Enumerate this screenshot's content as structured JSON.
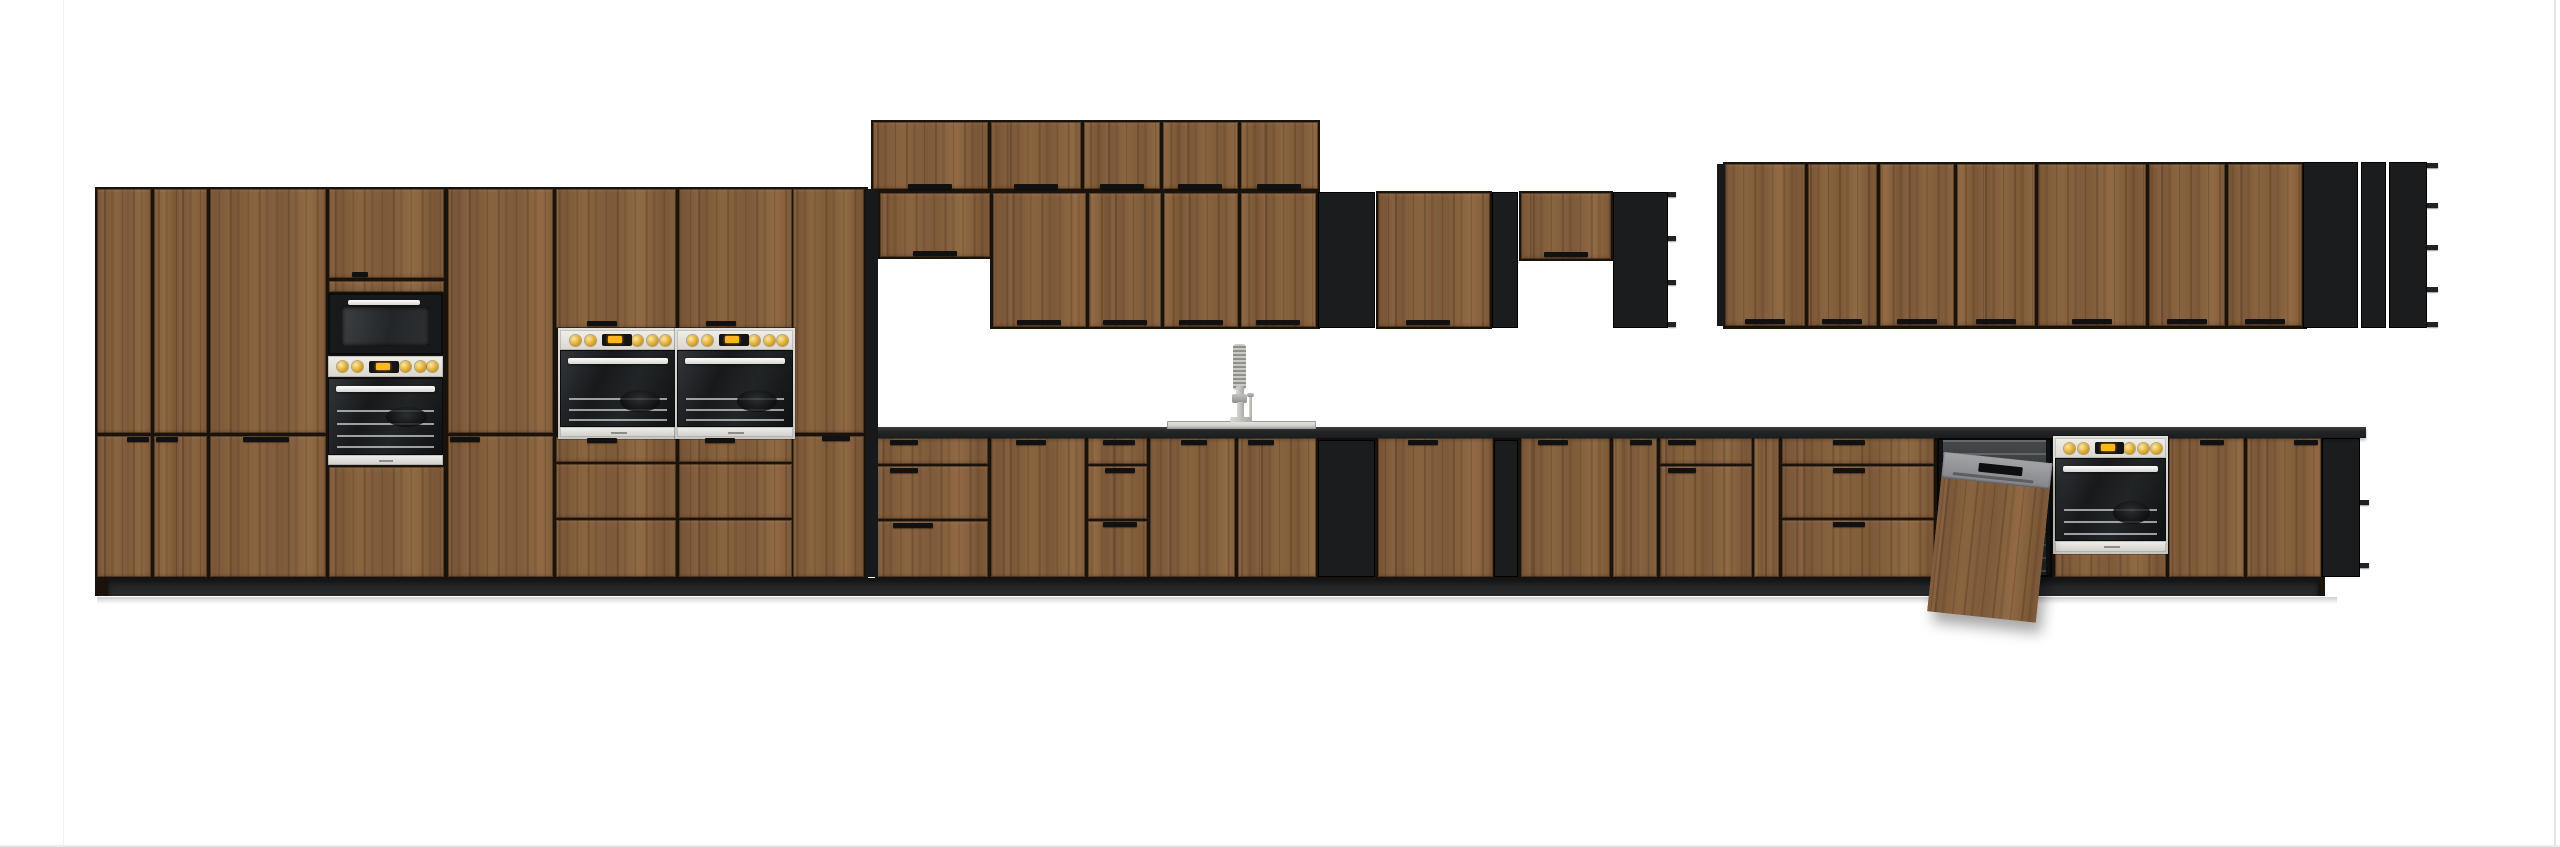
{
  "scene": {
    "width": 2560,
    "height": 847,
    "background": "#ffffff",
    "description": "front elevation render of a modular kitchen furniture set, dark oak wood fronts with black open shelving and black worktop"
  },
  "colors": {
    "wood_base": "#85603c",
    "wood_dark": "#5f4126",
    "carcass": "#1a130c",
    "black_unit": "#17191b",
    "counter": "#232527",
    "plinth": "#26282a",
    "stainless": "#d9d8d3",
    "panel_cream": "#e9e7df",
    "accent_yellow": "#f2b41c",
    "dishwasher_gray": "#95969a",
    "handle": "#111111",
    "page_line": "#ececec",
    "floor_shadow": "#c6c6c6"
  },
  "page_lines": [
    {
      "n": "page-border-left",
      "r": [
        63,
        0,
        1,
        847
      ],
      "c": "#f0f0f0"
    },
    {
      "n": "page-border-right",
      "r": [
        2554,
        0,
        2,
        847
      ],
      "c": "#e4e4e4"
    },
    {
      "n": "page-border-bottom",
      "r": [
        0,
        845,
        2560,
        2
      ],
      "c": "#ebebeb"
    }
  ],
  "shadows": [
    {
      "n": "floor-shadow",
      "r": [
        97,
        597,
        2240,
        7
      ]
    }
  ],
  "carcasses": [
    {
      "n": "tall-run-carcass",
      "r": [
        95,
        187,
        773,
        409
      ]
    },
    {
      "n": "wall-top-row-carcass",
      "r": [
        871,
        120,
        449,
        72
      ]
    },
    {
      "n": "wall-short-carcass",
      "r": [
        877,
        191,
        115,
        68
      ]
    },
    {
      "n": "wall-main-row-carcass",
      "r": [
        990,
        191,
        330,
        138
      ]
    },
    {
      "n": "wall-mid-door-carcass",
      "r": [
        1376,
        191,
        116,
        138
      ]
    },
    {
      "n": "wall-mid-short-carcass",
      "r": [
        1519,
        191,
        94,
        70
      ]
    },
    {
      "n": "wall-right-run-carcass",
      "r": [
        1723,
        162,
        584,
        167
      ]
    },
    {
      "n": "base-run-carcass",
      "r": [
        875,
        436,
        1450,
        160
      ]
    }
  ],
  "counter": {
    "n": "worktop",
    "r": [
      878,
      427,
      1488,
      11
    ]
  },
  "plinths": [
    {
      "n": "plinth",
      "r": [
        108,
        578,
        2210,
        18
      ]
    }
  ],
  "black_panels": [
    {
      "n": "tall-run-side-panel",
      "r": [
        866,
        189,
        12,
        388
      ]
    },
    {
      "n": "right-run-side-panel",
      "r": [
        1717,
        164,
        8,
        162
      ]
    }
  ],
  "wood_panels": [
    {
      "n": "tall-upper-door",
      "r": [
        97,
        189,
        54,
        244
      ]
    },
    {
      "n": "tall-upper-door",
      "r": [
        154,
        189,
        53,
        244
      ]
    },
    {
      "n": "tall-upper-door",
      "r": [
        210,
        189,
        116,
        244
      ]
    },
    {
      "n": "tower-upper-door",
      "r": [
        329,
        189,
        115,
        89
      ]
    },
    {
      "n": "tower-drawer-front",
      "r": [
        329,
        281,
        115,
        11
      ]
    },
    {
      "n": "tall-upper-door",
      "r": [
        448,
        189,
        105,
        244
      ]
    },
    {
      "n": "above-oven-door",
      "r": [
        556,
        189,
        120,
        139
      ]
    },
    {
      "n": "above-oven-door",
      "r": [
        679,
        189,
        113,
        139
      ]
    },
    {
      "n": "tall-upper-door",
      "r": [
        793,
        189,
        71,
        244
      ]
    },
    {
      "n": "tall-lower-door",
      "r": [
        97,
        436,
        54,
        141
      ]
    },
    {
      "n": "tall-lower-door",
      "r": [
        154,
        436,
        53,
        141
      ]
    },
    {
      "n": "tall-lower-door",
      "r": [
        210,
        436,
        116,
        141
      ]
    },
    {
      "n": "tower-lower-panel",
      "r": [
        329,
        467,
        115,
        110
      ]
    },
    {
      "n": "tall-lower-door",
      "r": [
        448,
        436,
        105,
        141
      ]
    },
    {
      "n": "under-oven-drawer",
      "r": [
        556,
        437,
        120,
        25
      ]
    },
    {
      "n": "under-oven-drawer",
      "r": [
        556,
        464,
        120,
        54
      ]
    },
    {
      "n": "under-oven-drawer",
      "r": [
        556,
        520,
        120,
        57
      ]
    },
    {
      "n": "under-oven-drawer",
      "r": [
        679,
        437,
        113,
        25
      ]
    },
    {
      "n": "under-oven-drawer",
      "r": [
        679,
        464,
        113,
        54
      ]
    },
    {
      "n": "under-oven-drawer",
      "r": [
        679,
        520,
        113,
        57
      ]
    },
    {
      "n": "tall-lower-door",
      "r": [
        793,
        436,
        71,
        141
      ]
    },
    {
      "n": "wall-top-door",
      "r": [
        873,
        122,
        115,
        67
      ]
    },
    {
      "n": "wall-top-door",
      "r": [
        991,
        122,
        90,
        67
      ]
    },
    {
      "n": "wall-top-door",
      "r": [
        1084,
        122,
        76,
        67
      ]
    },
    {
      "n": "wall-top-door",
      "r": [
        1163,
        122,
        75,
        67
      ]
    },
    {
      "n": "wall-top-door",
      "r": [
        1241,
        122,
        77,
        67
      ]
    },
    {
      "n": "wall-short-door",
      "r": [
        880,
        193,
        110,
        64
      ]
    },
    {
      "n": "wall-door",
      "r": [
        993,
        193,
        93,
        134
      ]
    },
    {
      "n": "wall-door",
      "r": [
        1089,
        193,
        72,
        134
      ]
    },
    {
      "n": "wall-door",
      "r": [
        1164,
        193,
        74,
        134
      ]
    },
    {
      "n": "wall-door",
      "r": [
        1241,
        193,
        75,
        134
      ]
    },
    {
      "n": "wall-mid-door",
      "r": [
        1378,
        193,
        112,
        134
      ]
    },
    {
      "n": "wall-mid-short-door",
      "r": [
        1521,
        193,
        90,
        66
      ]
    },
    {
      "n": "right-wall-door",
      "r": [
        1725,
        164,
        80,
        162
      ]
    },
    {
      "n": "right-wall-door",
      "r": [
        1808,
        164,
        69,
        162
      ]
    },
    {
      "n": "right-wall-door",
      "r": [
        1880,
        164,
        74,
        162
      ]
    },
    {
      "n": "right-wall-door",
      "r": [
        1957,
        164,
        78,
        162
      ]
    },
    {
      "n": "right-wall-door",
      "r": [
        2038,
        164,
        108,
        162
      ]
    },
    {
      "n": "right-wall-door",
      "r": [
        2149,
        164,
        76,
        162
      ]
    },
    {
      "n": "right-wall-door",
      "r": [
        2228,
        164,
        74,
        162
      ]
    },
    {
      "n": "base-drawer",
      "r": [
        877,
        438,
        111,
        26
      ]
    },
    {
      "n": "base-drawer",
      "r": [
        877,
        466,
        111,
        53
      ]
    },
    {
      "n": "base-drawer",
      "r": [
        877,
        521,
        111,
        56
      ]
    },
    {
      "n": "base-door",
      "r": [
        991,
        438,
        94,
        139
      ]
    },
    {
      "n": "base-drawer",
      "r": [
        1088,
        438,
        59,
        26
      ]
    },
    {
      "n": "base-drawer",
      "r": [
        1088,
        466,
        59,
        53
      ]
    },
    {
      "n": "base-drawer",
      "r": [
        1088,
        521,
        59,
        56
      ]
    },
    {
      "n": "sink-door",
      "r": [
        1150,
        438,
        85,
        139
      ]
    },
    {
      "n": "sink-door",
      "r": [
        1238,
        438,
        78,
        139
      ]
    },
    {
      "n": "base-door",
      "r": [
        1378,
        438,
        115,
        139
      ]
    },
    {
      "n": "base-door",
      "r": [
        1521,
        438,
        89,
        139
      ]
    },
    {
      "n": "base-door",
      "r": [
        1613,
        438,
        44,
        139
      ]
    },
    {
      "n": "base-drawer",
      "r": [
        1660,
        438,
        92,
        26
      ]
    },
    {
      "n": "base-door",
      "r": [
        1660,
        466,
        92,
        111
      ]
    },
    {
      "n": "base-filler",
      "r": [
        1754,
        438,
        25,
        139
      ]
    },
    {
      "n": "base-drawer",
      "r": [
        1782,
        438,
        152,
        26
      ]
    },
    {
      "n": "base-drawer",
      "r": [
        1782,
        466,
        152,
        52
      ]
    },
    {
      "n": "base-drawer",
      "r": [
        1782,
        520,
        152,
        57
      ]
    },
    {
      "n": "under-oven-panel",
      "r": [
        2055,
        552,
        111,
        25
      ]
    },
    {
      "n": "base-door",
      "r": [
        2169,
        438,
        75,
        139
      ]
    },
    {
      "n": "base-door",
      "r": [
        2247,
        438,
        74,
        139
      ]
    }
  ],
  "cubbies": [
    {
      "n": "open-shelf-wall-left",
      "r": [
        1318,
        192,
        57,
        136
      ],
      "rows": 3
    },
    {
      "n": "open-shelf-wall-narrow",
      "r": [
        1492,
        192,
        26,
        136
      ],
      "rows": 5
    },
    {
      "n": "open-shelf-wall-corner",
      "r": [
        1613,
        192,
        55,
        136
      ],
      "rows": 3,
      "tabs": {
        "x": 1668,
        "w": 8,
        "ys": [
          192,
          236,
          280,
          322
        ]
      }
    },
    {
      "n": "open-shelf-right-grid",
      "r": [
        2303,
        162,
        55,
        166
      ],
      "rows": 4
    },
    {
      "n": "open-shelf-right-narrow",
      "r": [
        2361,
        162,
        25,
        166
      ],
      "rows": 5
    },
    {
      "n": "open-shelf-right-corner",
      "r": [
        2389,
        162,
        38,
        166
      ],
      "rows": 4,
      "tabs": {
        "x": 2427,
        "w": 11,
        "ys": [
          163,
          203,
          245,
          287,
          322
        ]
      }
    },
    {
      "n": "open-shelf-base-left",
      "r": [
        1318,
        440,
        57,
        137
      ],
      "rows": 3
    },
    {
      "n": "open-shelf-base-narrow",
      "r": [
        1494,
        440,
        24,
        137
      ],
      "rows": 5
    },
    {
      "n": "open-shelf-base-end",
      "r": [
        2322,
        438,
        38,
        139
      ],
      "rows": 2,
      "tabs": {
        "x": 2360,
        "w": 9,
        "ys": [
          500,
          563
        ]
      }
    }
  ],
  "handles": [
    [
      352,
      272,
      16
    ],
    [
      587,
      321,
      30
    ],
    [
      706,
      321,
      30
    ],
    [
      127,
      437,
      22
    ],
    [
      156,
      437,
      22
    ],
    [
      243,
      437,
      46
    ],
    [
      450,
      437,
      30
    ],
    [
      822,
      436,
      28
    ],
    [
      587,
      438,
      30
    ],
    [
      705,
      438,
      30
    ],
    [
      908,
      184,
      44
    ],
    [
      1014,
      184,
      44
    ],
    [
      1100,
      184,
      44
    ],
    [
      1178,
      184,
      44
    ],
    [
      1257,
      184,
      44
    ],
    [
      913,
      251,
      44
    ],
    [
      1017,
      320,
      44
    ],
    [
      1103,
      320,
      44
    ],
    [
      1179,
      320,
      44
    ],
    [
      1256,
      320,
      44
    ],
    [
      1406,
      320,
      44
    ],
    [
      1544,
      252,
      44
    ],
    [
      1745,
      319,
      40
    ],
    [
      1822,
      319,
      40
    ],
    [
      1897,
      319,
      40
    ],
    [
      1976,
      319,
      40
    ],
    [
      2072,
      319,
      40
    ],
    [
      2167,
      319,
      40
    ],
    [
      2245,
      319,
      40
    ],
    [
      890,
      440,
      28
    ],
    [
      890,
      468,
      28
    ],
    [
      893,
      523,
      40
    ],
    [
      1016,
      440,
      30
    ],
    [
      1103,
      440,
      32
    ],
    [
      1105,
      468,
      30
    ],
    [
      1103,
      522,
      34
    ],
    [
      1181,
      440,
      26
    ],
    [
      1248,
      440,
      26
    ],
    [
      1408,
      440,
      30
    ],
    [
      1538,
      440,
      30
    ],
    [
      1630,
      440,
      22
    ],
    [
      1668,
      440,
      28
    ],
    [
      1668,
      468,
      28
    ],
    [
      1833,
      440,
      32
    ],
    [
      1833,
      468,
      32
    ],
    [
      1833,
      522,
      32
    ],
    [
      2200,
      440,
      24
    ],
    [
      2294,
      440,
      24
    ]
  ],
  "appliances": {
    "microwave": {
      "n": "built-in-microwave",
      "r": [
        328,
        293,
        115,
        62
      ]
    },
    "tower_control": {
      "n": "tower-control-strip",
      "r": [
        328,
        356,
        115,
        21
      ]
    },
    "tower_oven": {
      "n": "built-in-oven-tower",
      "r": [
        328,
        378,
        115,
        87
      ]
    },
    "wall_ovens": [
      {
        "n": "built-in-double-oven-left",
        "r": [
          560,
          330,
          116,
          107
        ]
      },
      {
        "n": "built-in-double-oven-right",
        "r": [
          677,
          330,
          116,
          107
        ]
      }
    ],
    "base_oven": {
      "n": "built-in-oven-right",
      "r": [
        2055,
        438,
        111,
        114
      ]
    },
    "dishwasher": {
      "n": "semi-integrated-dishwasher",
      "opening": [
        1937,
        438,
        115,
        139
      ],
      "tub": [
        1943,
        440,
        103,
        135
      ],
      "door": [
        1944,
        452,
        109,
        160
      ],
      "strip_h": 26
    },
    "sink": {
      "n": "inset-sink",
      "rim": [
        1167,
        421,
        149,
        8
      ]
    },
    "faucet": {
      "n": "kitchen-faucet",
      "parts": [
        {
          "cls": "spring",
          "r": [
            1233,
            344,
            13,
            46
          ]
        },
        {
          "cls": "metal",
          "r": [
            1236,
            386,
            8,
            14
          ]
        },
        {
          "cls": "metaldark",
          "r": [
            1232,
            394,
            15,
            9
          ]
        },
        {
          "cls": "metal",
          "r": [
            1237,
            402,
            7,
            20
          ]
        },
        {
          "cls": "metal",
          "r": [
            1249,
            396,
            3,
            26
          ]
        },
        {
          "cls": "metaldark",
          "r": [
            1247,
            393,
            7,
            4
          ]
        },
        {
          "cls": "metal",
          "r": [
            1230,
            417,
            21,
            5
          ]
        }
      ]
    }
  }
}
